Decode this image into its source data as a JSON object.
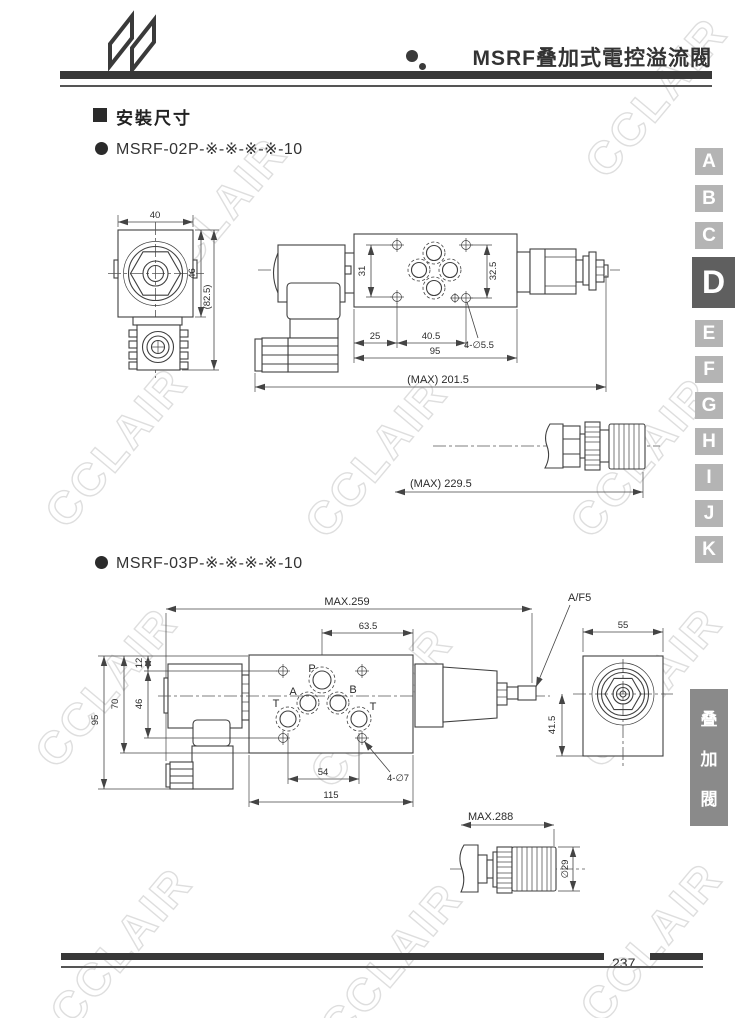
{
  "header": {
    "title": "MSRF叠加式電控溢流閥",
    "logo": "n-ribbon-logo"
  },
  "section_heading": "安裝尺寸",
  "models": [
    "MSRF-02P-※-※-※-※-10",
    "MSRF-03P-※-※-※-※-10"
  ],
  "drawing1": {
    "dims": {
      "top_width": "40",
      "body_height": "46",
      "overall_height": "(82.5)",
      "hole_span_left": "31",
      "hole_span_right": "32.5",
      "edge_to_hole": "25",
      "hole_to_hole": "40.5",
      "mounting_holes": "4-∅5.5",
      "plate_width": "95",
      "overall_length": "(MAX)  201.5",
      "overall_length_knob": "(MAX)  229.5"
    }
  },
  "drawing2": {
    "dims": {
      "overall_length": "MAX.259",
      "port_to_edge": "63.5",
      "hex_flats": "A/F5",
      "end_width": "55",
      "plate_top_to_hole": "12",
      "hole_span": "46",
      "coil_height": "70",
      "overall_height": "95",
      "center_to_bottom": "41.5",
      "tank_port_span": "54",
      "mounting_holes": "4-∅7",
      "plate_length": "115",
      "overall_length_knob": "MAX.288",
      "knob_diameter": "∅29"
    },
    "ports": {
      "p": "P",
      "a": "A",
      "b": "B",
      "t_left": "T",
      "t_right": "T"
    }
  },
  "sidebar": {
    "tabs": [
      "A",
      "B",
      "C",
      "D",
      "E",
      "F",
      "G",
      "H",
      "I",
      "J",
      "K"
    ],
    "active_tab": "D"
  },
  "category_tab": {
    "line1": "叠",
    "line2": "加",
    "line3": "閥"
  },
  "footer": {
    "page_number": "237"
  },
  "watermark": {
    "text": "CCLAIR"
  }
}
